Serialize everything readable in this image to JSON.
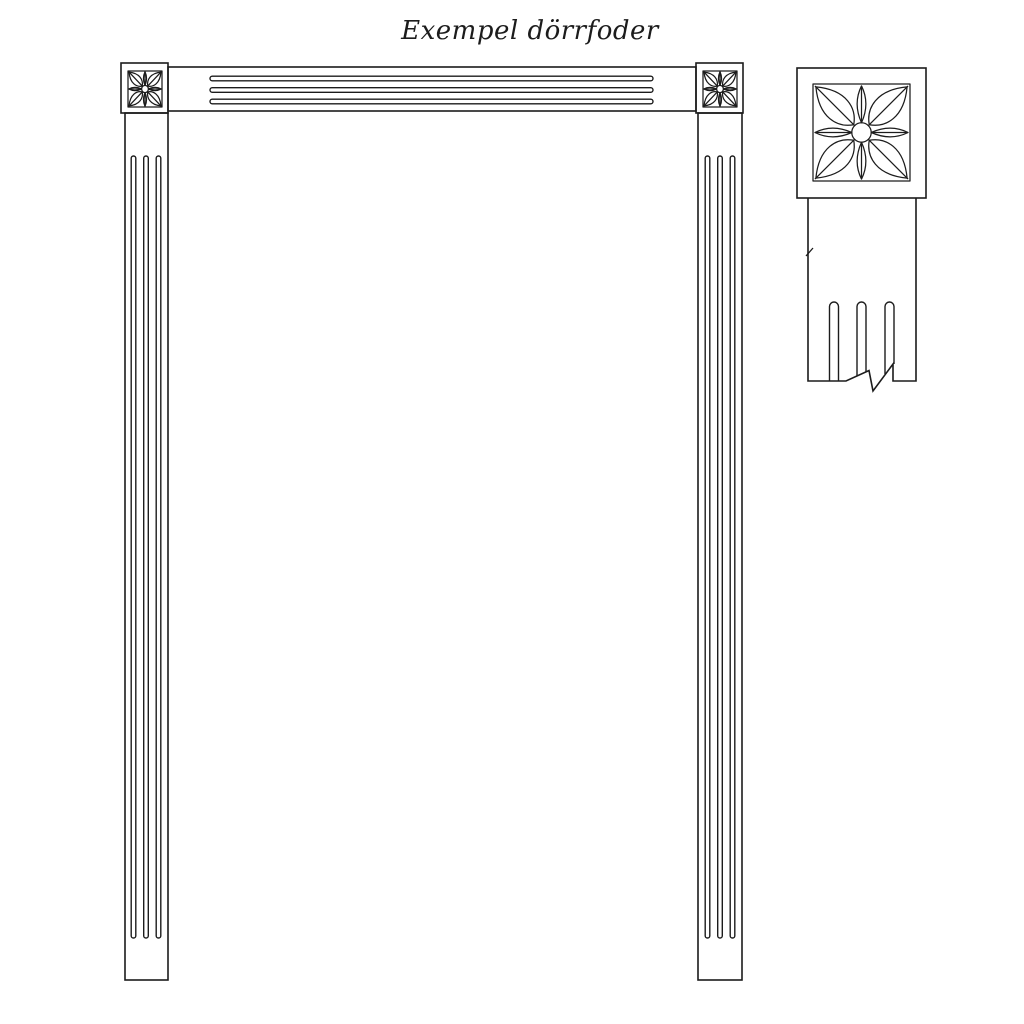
{
  "page": {
    "title": "Exempel dörrfoder"
  },
  "colors": {
    "line": "#1c1c1c",
    "background": "#ffffff"
  },
  "drawing": {
    "kind": "technical line drawing",
    "subject": "door casing (dörrfoder) elevation with fluted casings, carved corner rosette blocks and an enlarged corner detail with break line",
    "icons": {
      "rosette": "rosette-flower-icon"
    }
  }
}
